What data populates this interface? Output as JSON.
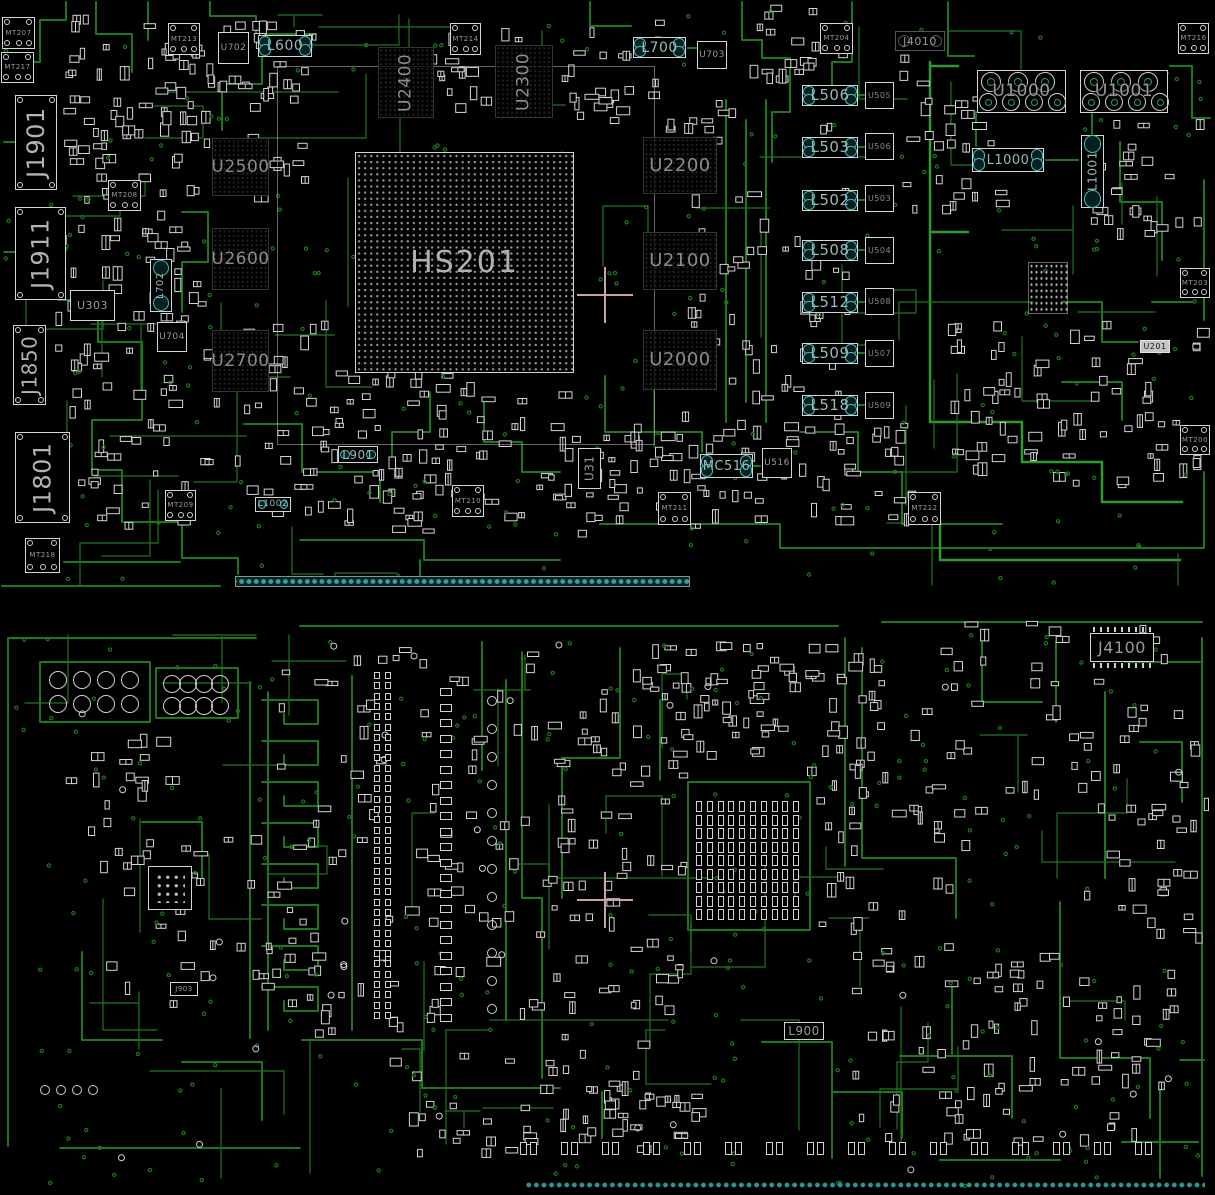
{
  "colors": {
    "background": "#000000",
    "trace": "#1c781c",
    "trace_bright": "#2f9b2f",
    "silkscreen": "#d4d4d4",
    "designator_text": "#9a9a9a",
    "inductor_pad": "#41bcbc",
    "edge_pad": "#2fa3a3",
    "crosshair": "#cf9fb0"
  },
  "components": [
    {
      "id": "MT207",
      "label": "MT207",
      "kind": "mount",
      "x": 2,
      "y": 17,
      "w": 33,
      "h": 32
    },
    {
      "id": "MT217",
      "label": "MT217",
      "kind": "mount",
      "x": 1,
      "y": 52,
      "w": 33,
      "h": 31
    },
    {
      "id": "MT213",
      "label": "MT213",
      "kind": "mount",
      "x": 168,
      "y": 23,
      "w": 32,
      "h": 32
    },
    {
      "id": "U702",
      "label": "U702",
      "kind": "ic",
      "x": 218,
      "y": 32,
      "w": 31,
      "h": 32,
      "fs": 9
    },
    {
      "id": "L600",
      "label": "L600",
      "kind": "ind-h",
      "x": 258,
      "y": 35,
      "w": 54,
      "h": 22,
      "fs": 14
    },
    {
      "id": "MT214",
      "label": "MT214",
      "kind": "mount",
      "x": 450,
      "y": 23,
      "w": 31,
      "h": 32
    },
    {
      "id": "U2400",
      "label": "U2400",
      "kind": "mem",
      "x": 378,
      "y": 47,
      "w": 56,
      "h": 71,
      "o": "v",
      "fs": 17
    },
    {
      "id": "U2300",
      "label": "U2300",
      "kind": "mem",
      "x": 495,
      "y": 45,
      "w": 58,
      "h": 73,
      "o": "v",
      "fs": 17
    },
    {
      "id": "L700",
      "label": "L700",
      "kind": "ind-h",
      "x": 633,
      "y": 37,
      "w": 53,
      "h": 21,
      "fs": 14
    },
    {
      "id": "U703",
      "label": "U703",
      "kind": "ic",
      "x": 697,
      "y": 41,
      "w": 30,
      "h": 28,
      "fs": 9
    },
    {
      "id": "MT204",
      "label": "MT204",
      "kind": "mount",
      "x": 820,
      "y": 23,
      "w": 33,
      "h": 31
    },
    {
      "id": "J4010",
      "label": "J4010",
      "kind": "jport",
      "x": 895,
      "y": 31,
      "w": 50,
      "h": 20,
      "fs": 11
    },
    {
      "id": "MT216",
      "label": "MT216",
      "kind": "mount",
      "x": 1178,
      "y": 23,
      "w": 31,
      "h": 31
    },
    {
      "id": "U1000",
      "label": "U1000",
      "kind": "power",
      "x": 977,
      "y": 70,
      "w": 89,
      "h": 43,
      "fs": 17
    },
    {
      "id": "U1001",
      "label": "U1001",
      "kind": "power",
      "x": 1080,
      "y": 70,
      "w": 88,
      "h": 43,
      "fs": 17
    },
    {
      "id": "L1000",
      "label": "L1000",
      "kind": "ind-h",
      "x": 972,
      "y": 148,
      "w": 72,
      "h": 24,
      "fs": 13
    },
    {
      "id": "L1001",
      "label": "L1001",
      "kind": "ind-v",
      "x": 1081,
      "y": 135,
      "w": 23,
      "h": 73,
      "fs": 12
    },
    {
      "id": "J1901",
      "label": "J1901",
      "kind": "conn",
      "x": 15,
      "y": 95,
      "w": 42,
      "h": 95,
      "fs": 24
    },
    {
      "id": "J1911",
      "label": "J1911",
      "kind": "conn",
      "x": 15,
      "y": 207,
      "w": 51,
      "h": 93,
      "fs": 24
    },
    {
      "id": "J1850",
      "label": "J1850",
      "kind": "conn",
      "x": 13,
      "y": 325,
      "w": 33,
      "h": 80,
      "fs": 20
    },
    {
      "id": "J1801",
      "label": "J1801",
      "kind": "conn",
      "x": 15,
      "y": 432,
      "w": 55,
      "h": 91,
      "fs": 24
    },
    {
      "id": "MT218",
      "label": "MT218",
      "kind": "mount",
      "x": 25,
      "y": 538,
      "w": 35,
      "h": 35
    },
    {
      "id": "MT208",
      "label": "MT208",
      "kind": "mount",
      "x": 108,
      "y": 180,
      "w": 33,
      "h": 31
    },
    {
      "id": "U303",
      "label": "U303",
      "kind": "ic",
      "x": 70,
      "y": 290,
      "w": 45,
      "h": 31,
      "fs": 11
    },
    {
      "id": "L702",
      "label": "L702",
      "kind": "ind-v",
      "x": 150,
      "y": 259,
      "w": 22,
      "h": 53,
      "fs": 10
    },
    {
      "id": "U704",
      "label": "U704",
      "kind": "ic",
      "x": 157,
      "y": 322,
      "w": 30,
      "h": 30,
      "fs": 9
    },
    {
      "id": "U2500",
      "label": "U2500",
      "kind": "mem",
      "x": 212,
      "y": 138,
      "w": 57,
      "h": 58,
      "fs": 17
    },
    {
      "id": "U2600",
      "label": "U2600",
      "kind": "mem",
      "x": 212,
      "y": 228,
      "w": 57,
      "h": 62,
      "fs": 17
    },
    {
      "id": "U2700",
      "label": "U2700",
      "kind": "mem",
      "x": 212,
      "y": 330,
      "w": 57,
      "h": 62,
      "fs": 17
    },
    {
      "id": "HS201",
      "label": "HS201",
      "kind": "bga",
      "x": 355,
      "y": 152,
      "w": 219,
      "h": 221,
      "fs": 30
    },
    {
      "id": "U2200",
      "label": "U2200",
      "kind": "mem",
      "x": 643,
      "y": 137,
      "w": 74,
      "h": 57,
      "fs": 18
    },
    {
      "id": "U2100",
      "label": "U2100",
      "kind": "mem",
      "x": 643,
      "y": 232,
      "w": 74,
      "h": 58,
      "fs": 18
    },
    {
      "id": "U2000",
      "label": "U2000",
      "kind": "mem",
      "x": 643,
      "y": 330,
      "w": 74,
      "h": 60,
      "fs": 18
    },
    {
      "id": "L506",
      "label": "L506",
      "kind": "ind-h",
      "x": 802,
      "y": 85,
      "w": 56,
      "h": 21,
      "fs": 15
    },
    {
      "id": "L503",
      "label": "L503",
      "kind": "ind-h",
      "x": 802,
      "y": 137,
      "w": 56,
      "h": 21,
      "fs": 15
    },
    {
      "id": "L502",
      "label": "L502",
      "kind": "ind-h",
      "x": 802,
      "y": 190,
      "w": 56,
      "h": 21,
      "fs": 15
    },
    {
      "id": "L508",
      "label": "L508",
      "kind": "ind-h",
      "x": 802,
      "y": 240,
      "w": 56,
      "h": 21,
      "fs": 15
    },
    {
      "id": "L512",
      "label": "L512",
      "kind": "ind-h",
      "x": 802,
      "y": 292,
      "w": 56,
      "h": 21,
      "fs": 15
    },
    {
      "id": "L509",
      "label": "L509",
      "kind": "ind-h",
      "x": 802,
      "y": 343,
      "w": 56,
      "h": 21,
      "fs": 15
    },
    {
      "id": "L518",
      "label": "L518",
      "kind": "ind-h",
      "x": 802,
      "y": 395,
      "w": 56,
      "h": 21,
      "fs": 15
    },
    {
      "id": "U505",
      "label": "U505",
      "kind": "icsmall",
      "x": 865,
      "y": 82,
      "w": 29,
      "h": 27,
      "fs": 8
    },
    {
      "id": "U506",
      "label": "U506",
      "kind": "icsmall",
      "x": 865,
      "y": 133,
      "w": 29,
      "h": 27,
      "fs": 8
    },
    {
      "id": "U503",
      "label": "U503",
      "kind": "icsmall",
      "x": 865,
      "y": 185,
      "w": 29,
      "h": 27,
      "fs": 8
    },
    {
      "id": "U504",
      "label": "U504",
      "kind": "icsmall",
      "x": 865,
      "y": 237,
      "w": 29,
      "h": 27,
      "fs": 8
    },
    {
      "id": "U508b",
      "label": "U508",
      "kind": "icsmall",
      "x": 865,
      "y": 288,
      "w": 29,
      "h": 27,
      "fs": 8
    },
    {
      "id": "U507",
      "label": "U507",
      "kind": "icsmall",
      "x": 865,
      "y": 340,
      "w": 29,
      "h": 27,
      "fs": 8
    },
    {
      "id": "U509",
      "label": "U509",
      "kind": "icsmall",
      "x": 865,
      "y": 392,
      "w": 29,
      "h": 27,
      "fs": 8
    },
    {
      "id": "MT203",
      "label": "MT203",
      "kind": "mount",
      "x": 1180,
      "y": 268,
      "w": 30,
      "h": 30
    },
    {
      "id": "U201",
      "label": "U201",
      "kind": "tag",
      "x": 1140,
      "y": 340,
      "w": 30,
      "h": 13,
      "fs": 8
    },
    {
      "id": "MT200",
      "label": "MT200",
      "kind": "mount",
      "x": 1180,
      "y": 425,
      "w": 30,
      "h": 30
    },
    {
      "id": "MT209",
      "label": "MT209",
      "kind": "mount",
      "x": 165,
      "y": 490,
      "w": 31,
      "h": 31
    },
    {
      "id": "L1002",
      "label": "L1002",
      "kind": "ind-h",
      "x": 255,
      "y": 497,
      "w": 36,
      "h": 15,
      "fs": 9
    },
    {
      "id": "L901",
      "label": "L901",
      "kind": "ind-h",
      "x": 338,
      "y": 446,
      "w": 40,
      "h": 17,
      "fs": 12
    },
    {
      "id": "MT210",
      "label": "MT210",
      "kind": "mount",
      "x": 452,
      "y": 485,
      "w": 32,
      "h": 32
    },
    {
      "id": "U31",
      "label": "U31",
      "kind": "ic",
      "x": 578,
      "y": 448,
      "w": 23,
      "h": 41,
      "o": "v",
      "fs": 12
    },
    {
      "id": "MC516",
      "label": "MC516",
      "kind": "ind-h",
      "x": 700,
      "y": 454,
      "w": 53,
      "h": 24,
      "fs": 13
    },
    {
      "id": "U516",
      "label": "U516",
      "kind": "ic",
      "x": 762,
      "y": 448,
      "w": 30,
      "h": 30,
      "fs": 9
    },
    {
      "id": "MT211",
      "label": "MT211",
      "kind": "mount",
      "x": 658,
      "y": 492,
      "w": 33,
      "h": 33
    },
    {
      "id": "MT212",
      "label": "MT212",
      "kind": "mount",
      "x": 908,
      "y": 492,
      "w": 33,
      "h": 33
    },
    {
      "id": "dot-block",
      "kind": "dotblock",
      "x": 1028,
      "y": 262,
      "w": 40,
      "h": 52
    },
    {
      "id": "bga-region",
      "kind": "region",
      "x": 277,
      "y": 66,
      "w": 378,
      "h": 379
    },
    {
      "id": "edge-strip-top",
      "kind": "strip",
      "x": 235,
      "y": 576,
      "w": 455,
      "h": 11
    },
    {
      "id": "cross-top",
      "kind": "cross",
      "x": 605,
      "y": 295
    },
    {
      "id": "J4100",
      "label": "J4100",
      "kind": "jbox",
      "x": 1090,
      "y": 633,
      "w": 64,
      "h": 29,
      "fs": 16
    },
    {
      "id": "holes-a",
      "kind": "holes4x2",
      "x": 46,
      "y": 668,
      "w": 96,
      "h": 48
    },
    {
      "id": "holes-b",
      "kind": "holes4x2",
      "x": 160,
      "y": 672,
      "w": 72,
      "h": 46
    },
    {
      "id": "qfn-u",
      "kind": "qfn",
      "x": 148,
      "y": 866,
      "w": 44,
      "h": 44
    },
    {
      "id": "J903",
      "label": "J903",
      "kind": "tago",
      "x": 170,
      "y": 982,
      "w": 28,
      "h": 14,
      "fs": 7
    },
    {
      "id": "cap-grid",
      "kind": "capgrid",
      "x": 695,
      "y": 800,
      "w": 108,
      "h": 122
    },
    {
      "id": "cross-bottom",
      "kind": "cross",
      "x": 605,
      "y": 900
    },
    {
      "id": "L900",
      "label": "L900",
      "kind": "ind-plain",
      "x": 784,
      "y": 1022,
      "w": 40,
      "h": 18,
      "fs": 12
    },
    {
      "id": "padcol-1",
      "kind": "padcol-pairs",
      "x": 374,
      "y": 672,
      "rows": 34,
      "dy": 10.3
    },
    {
      "id": "padcol-2",
      "kind": "padcol-single",
      "x": 440,
      "y": 688,
      "rows": 22,
      "dy": 15.5
    },
    {
      "id": "circle-col",
      "kind": "circlecol",
      "x": 487,
      "y": 696,
      "rows": 12,
      "dy": 28
    },
    {
      "id": "padrow-bottom",
      "kind": "padrow",
      "x": 520,
      "y": 1142,
      "cols": 16,
      "dx": 41
    },
    {
      "id": "edge-strip-bottom",
      "kind": "strip2",
      "x": 525,
      "y": 1179,
      "w": 680,
      "h": 12
    },
    {
      "id": "holes-small",
      "kind": "circlerow",
      "x": 40,
      "y": 1085,
      "cols": 4,
      "dx": 16
    }
  ]
}
